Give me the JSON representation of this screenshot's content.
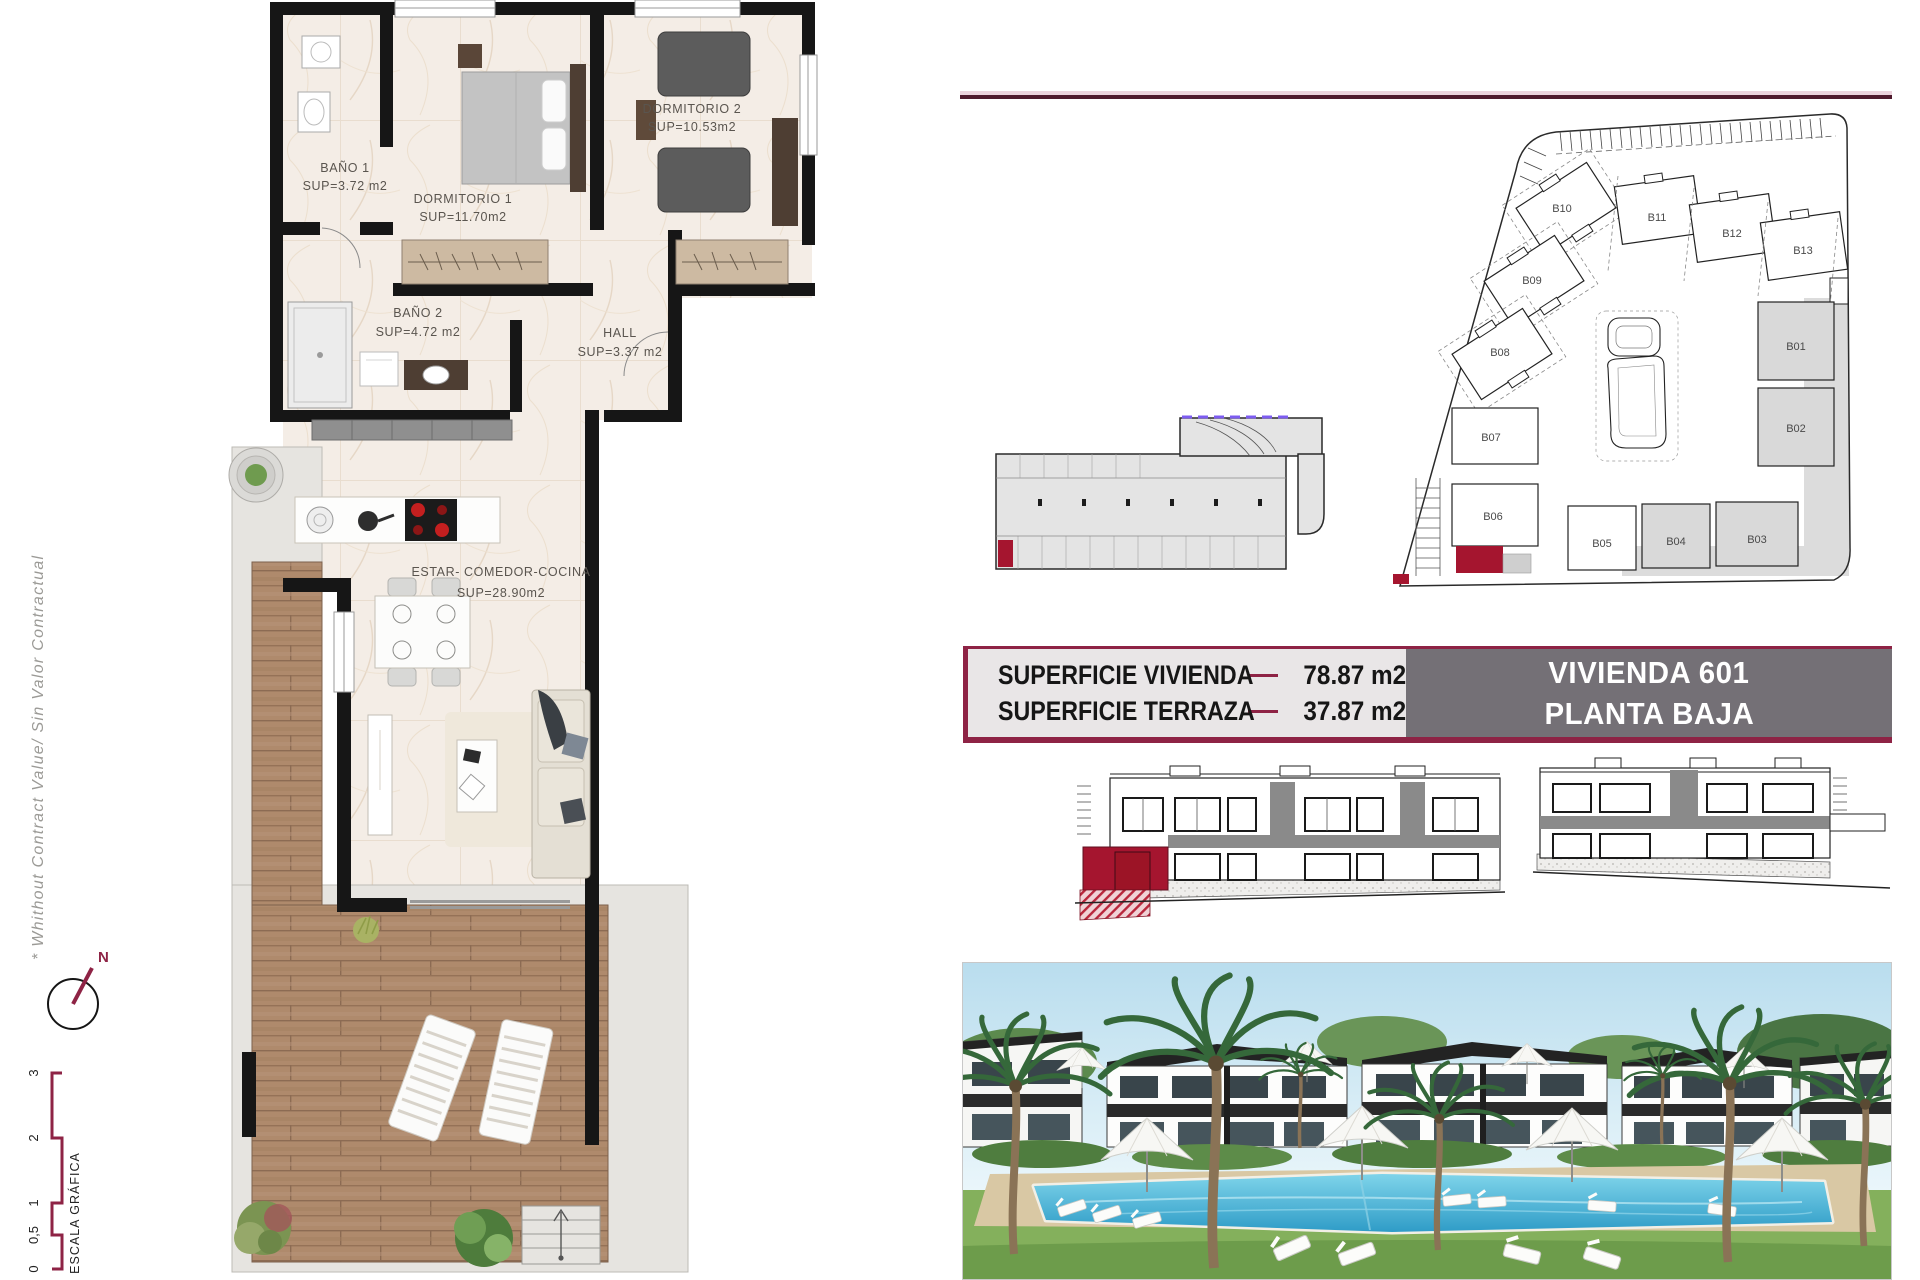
{
  "left_rail": {
    "disclaimer": "* Whithout Contract Value/ Sin Valor Contractual",
    "compass_label": "N",
    "scale_title": "ESCALA GRÁFICA",
    "scale_ticks": [
      "0",
      "0,5",
      "1",
      "2",
      "3"
    ]
  },
  "floorplan": {
    "rooms": [
      {
        "name": "BAÑO 1",
        "area": "SUP=3.72 m2"
      },
      {
        "name": "DORMITORIO 1",
        "area": "SUP=11.70m2"
      },
      {
        "name": "DORMITORIO 2",
        "area": "SUP=10.53m2"
      },
      {
        "name": "BAÑO 2",
        "area": "SUP=4.72 m2"
      },
      {
        "name": "HALL",
        "area": "SUP=3.37 m2"
      },
      {
        "name": "ESTAR- COMEDOR-COCINA",
        "area": "SUP=28.90m2"
      }
    ]
  },
  "siteplan": {
    "blocks": [
      "B01",
      "B02",
      "B03",
      "B04",
      "B05",
      "B06",
      "B07",
      "B08",
      "B09",
      "B10",
      "B11",
      "B12",
      "B13"
    ]
  },
  "summary": {
    "rows": [
      {
        "label": "SUPERFICIE VIVIENDA",
        "value": "78.87 m2"
      },
      {
        "label": "SUPERFICIE TERRAZA",
        "value": "37.87 m2"
      }
    ],
    "unit_name": "VIVIENDA 601",
    "unit_floor": "PLANTA BAJA"
  },
  "colors": {
    "maroon_rule": "#4f1a2d",
    "maroon": "#8e2345",
    "accent_red": "#a5152f",
    "unit_box_bg": "#747076",
    "table_bg": "#e9e6e7",
    "purple_dash": "#7d5cf0"
  }
}
